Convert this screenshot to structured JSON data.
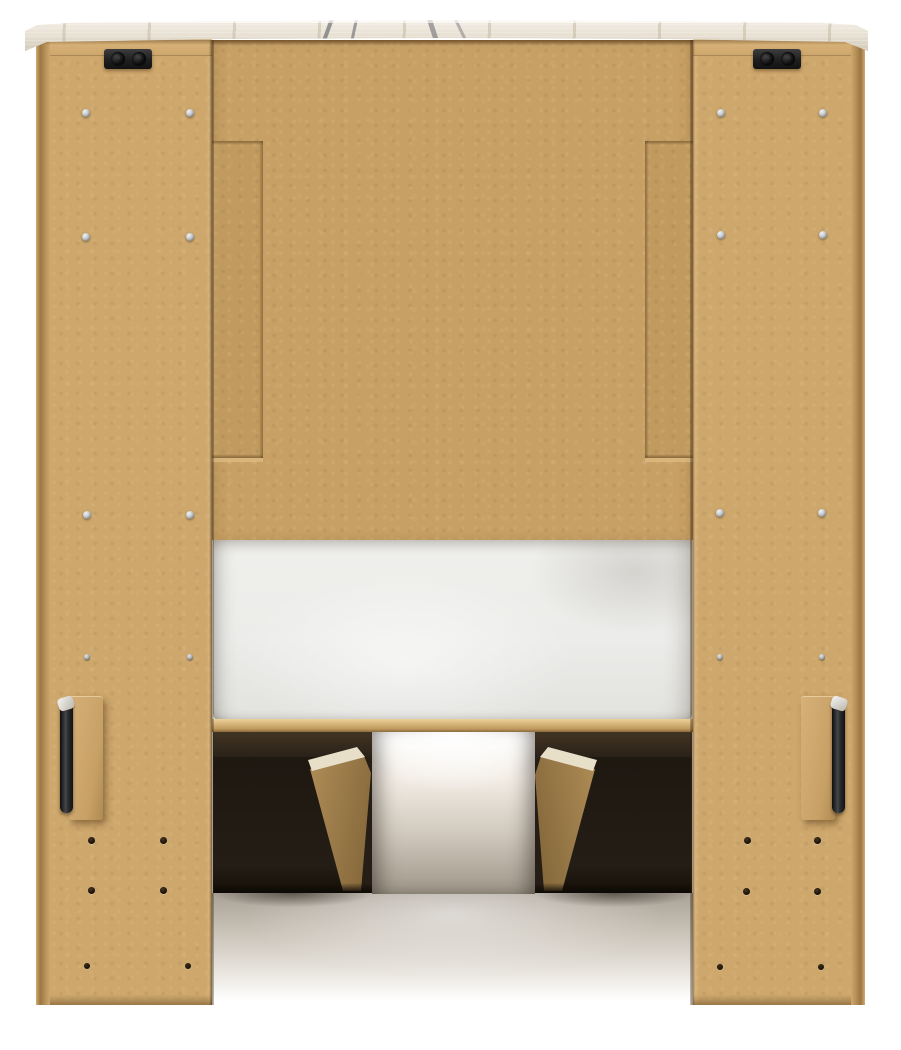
{
  "scene": {
    "type": "product-photo",
    "subject": "Back view of a bookcase storage bed frame with under-bed drawers",
    "visible_parts": [
      "whitewashed wood-grain top cap with dark grain streaks",
      "tan MDF back panels (left tower, center headboard panel, right tower)",
      "stepped notch filler strips on the center panel",
      "two black cam-lock brackets under the top cap",
      "silver assembly screws and black peg holes on side panels",
      "two black metal assembly handles on tan mounting blocks",
      "white upholstered foundation deck",
      "oak-tone bed rail",
      "two dark under-bed storage drawer boxes with oak side panels",
      "soft floor shadow beneath the bed"
    ],
    "background": "#ffffff"
  },
  "colors": {
    "mdf_face": "#cda76c",
    "mdf_center": "#c7a065",
    "mdf_strip": "#c09a5e",
    "top_board": "#e8e1d4",
    "board_grain": "#4b4e55",
    "rail": "#d9b87c",
    "mattress": "#efefec",
    "drawer_dark": "#241d15",
    "drawer_oak": "#b8945c",
    "oak_edge": "#e8dfc9",
    "bracket": "#1f1f1f",
    "screw": "#c3c6ca",
    "hole": "#17100a",
    "handle": "#2c2e31",
    "floor_shadow": "#aaa297"
  },
  "counts": {
    "assembly_screws": 12,
    "small_screws": 4,
    "peg_holes": 8,
    "small_peg_holes": 4,
    "cam_brackets": 2,
    "handles": 2,
    "drawers": 2
  }
}
